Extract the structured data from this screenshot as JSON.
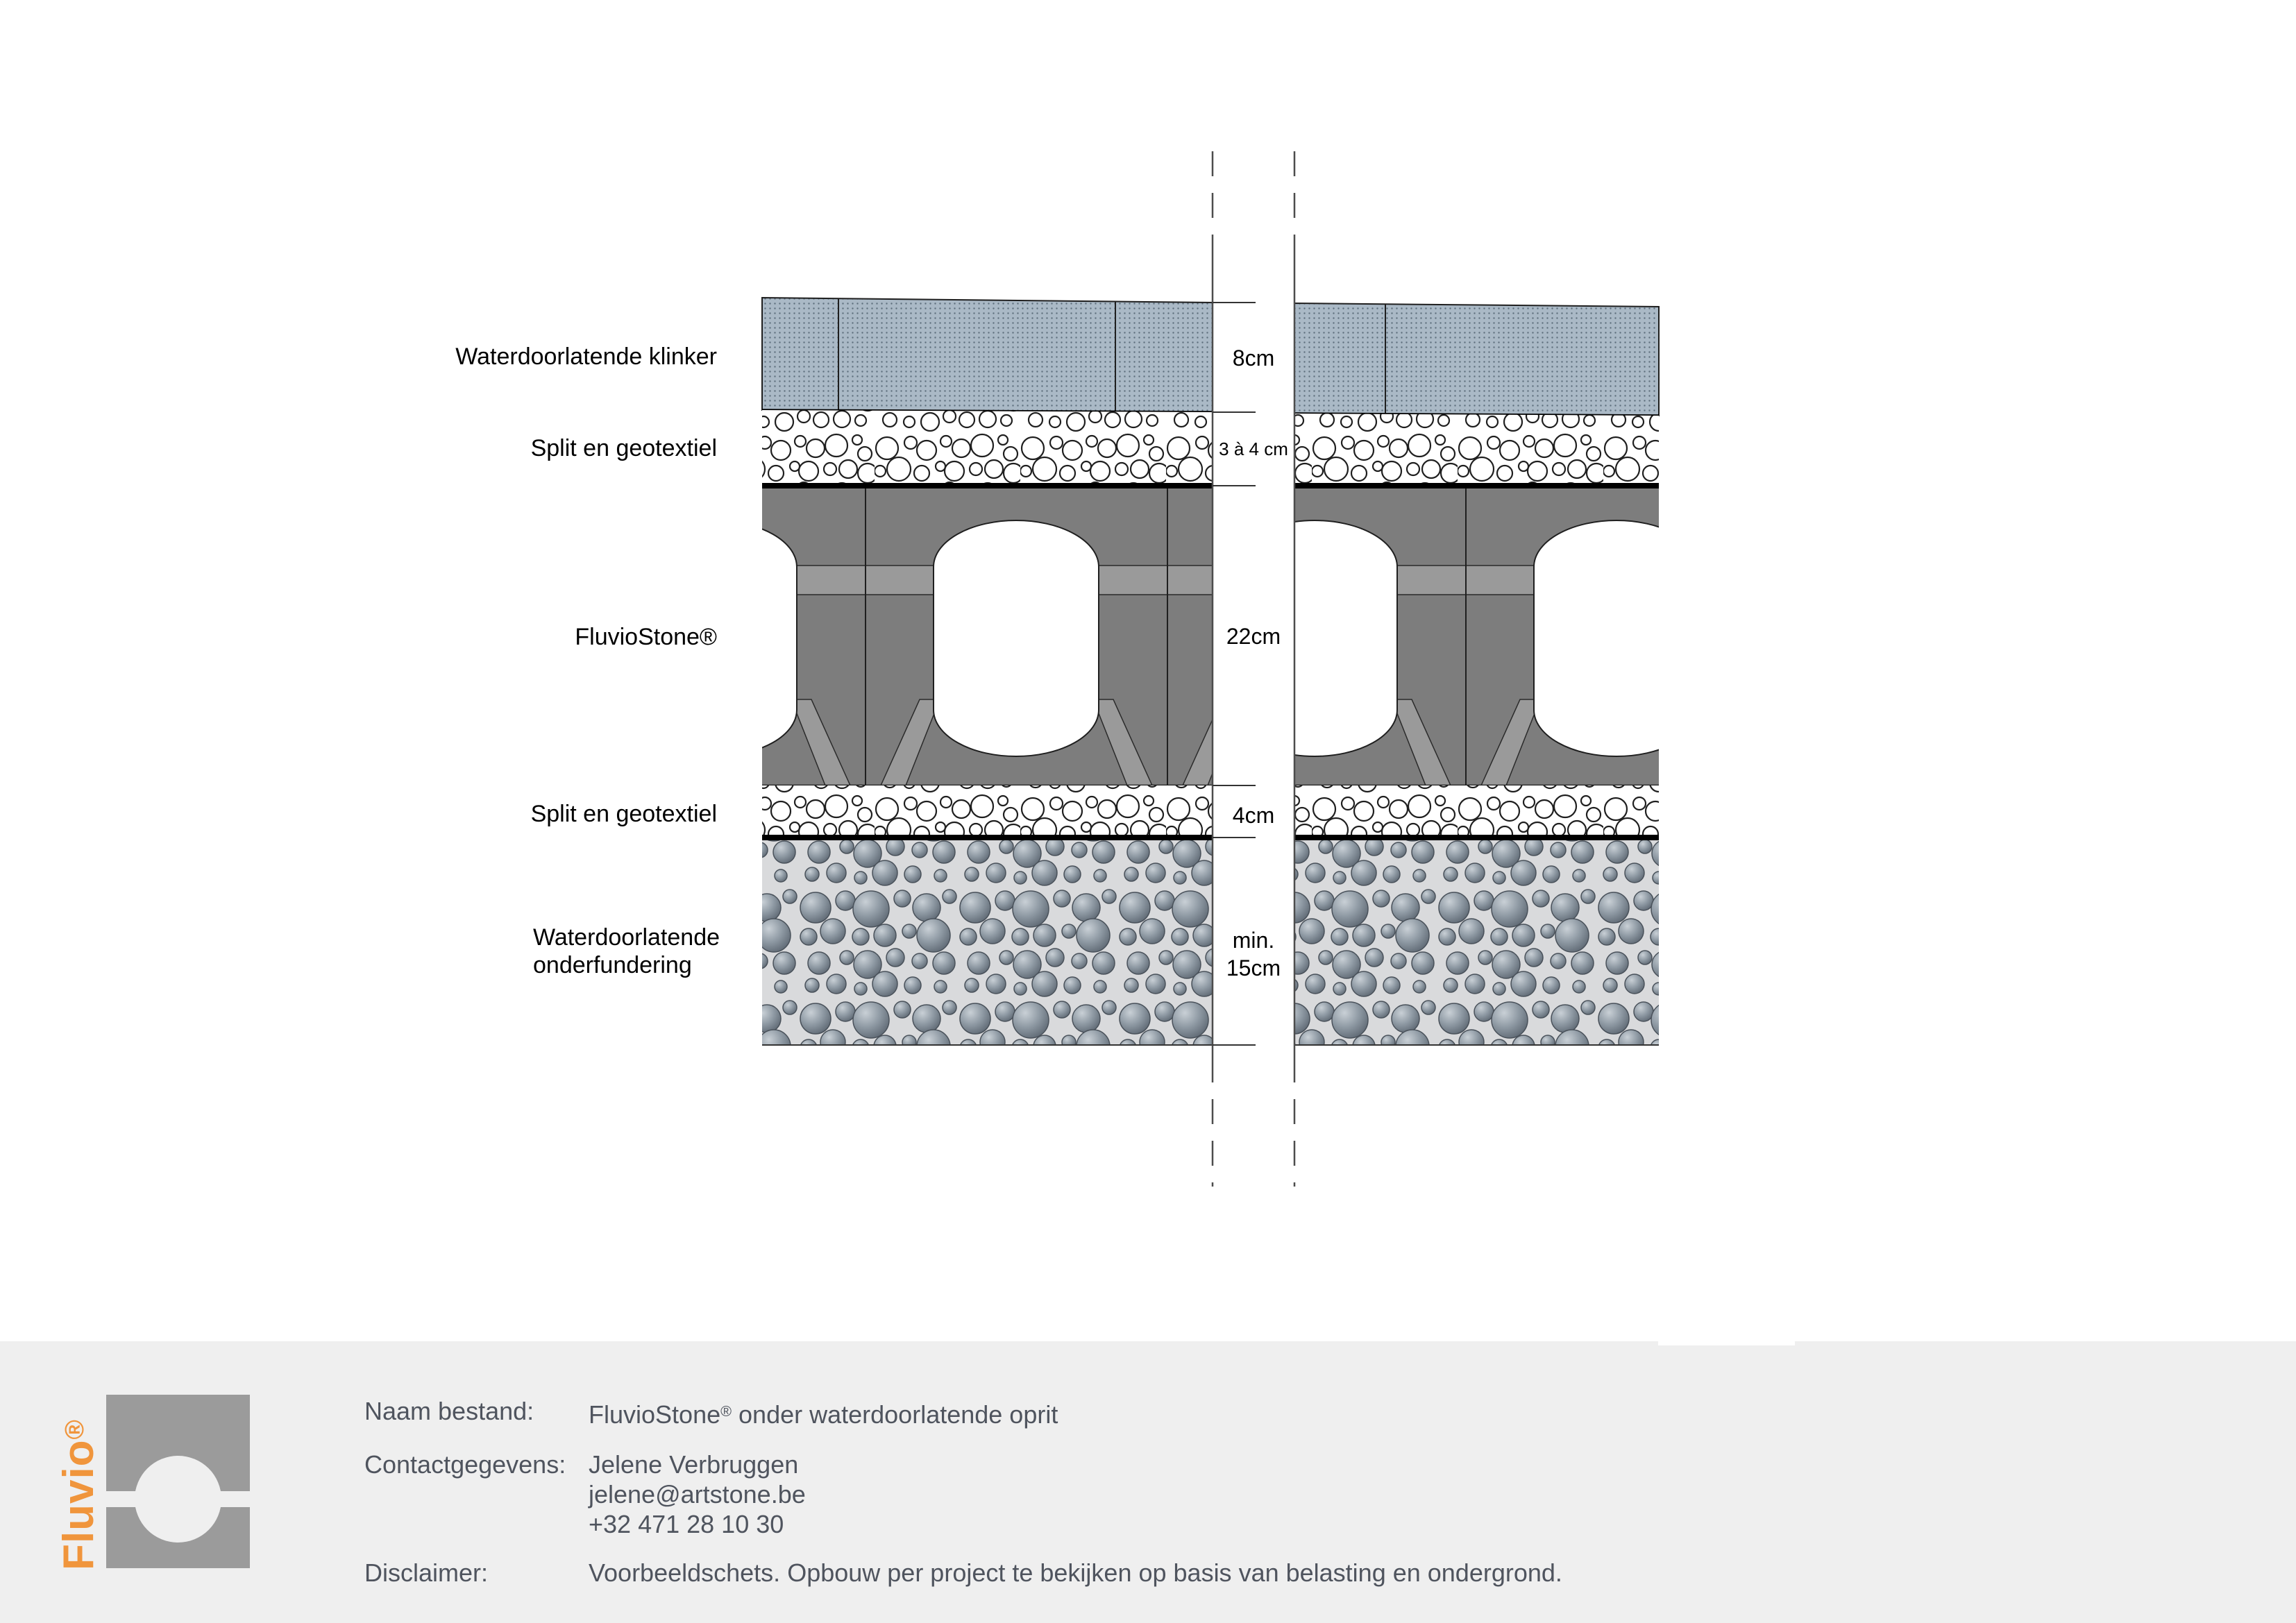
{
  "diagram": {
    "layer_labels": {
      "klinker": "Waterdoorlatende klinker",
      "split_top": "Split en geotextiel",
      "fluviostone": "FluvioStone®",
      "split_bottom": "Split en geotextiel",
      "foundation_line1": "Waterdoorlatende",
      "foundation_line2": "onderfundering"
    },
    "dimension_labels": {
      "klinker": "8cm",
      "split_top": "3 à 4 cm",
      "fluviostone": "22cm",
      "split_bottom": "4cm",
      "foundation_line1": "min.",
      "foundation_line2": "15cm"
    }
  },
  "footer": {
    "logo": {
      "text": "Fluvio",
      "reg": "®"
    },
    "rows": {
      "file": {
        "label": "Naam bestand:",
        "value_pre": "FluvioStone",
        "value_sup": "®",
        "value_post": " onder waterdoorlatende oprit"
      },
      "contact": {
        "label": "Contactgegevens:",
        "line1": "Jelene Verbruggen",
        "line2": "jelene@artstone.be",
        "line3": "+32 471 28 10 30"
      },
      "disclaimer": {
        "label": "Disclaimer:",
        "value": "Voorbeeldschets. Opbouw per project te bekijken op basis van belasting en ondergrond."
      }
    }
  },
  "colors": {
    "paver_fill": "#aab9c6",
    "paver_dot": "#5f707e",
    "stone_gray": "#7d7d7d",
    "stone_light_band": "#9a9a9a",
    "geotextile_black": "#000000",
    "foundation_bg": "#d9dadc",
    "pebble_dark": "#5a646f",
    "footer_bg": "#efefef",
    "logo_orange": "#f0953c",
    "logo_gray": "#9b9b9b",
    "footer_text": "#4f545e"
  }
}
